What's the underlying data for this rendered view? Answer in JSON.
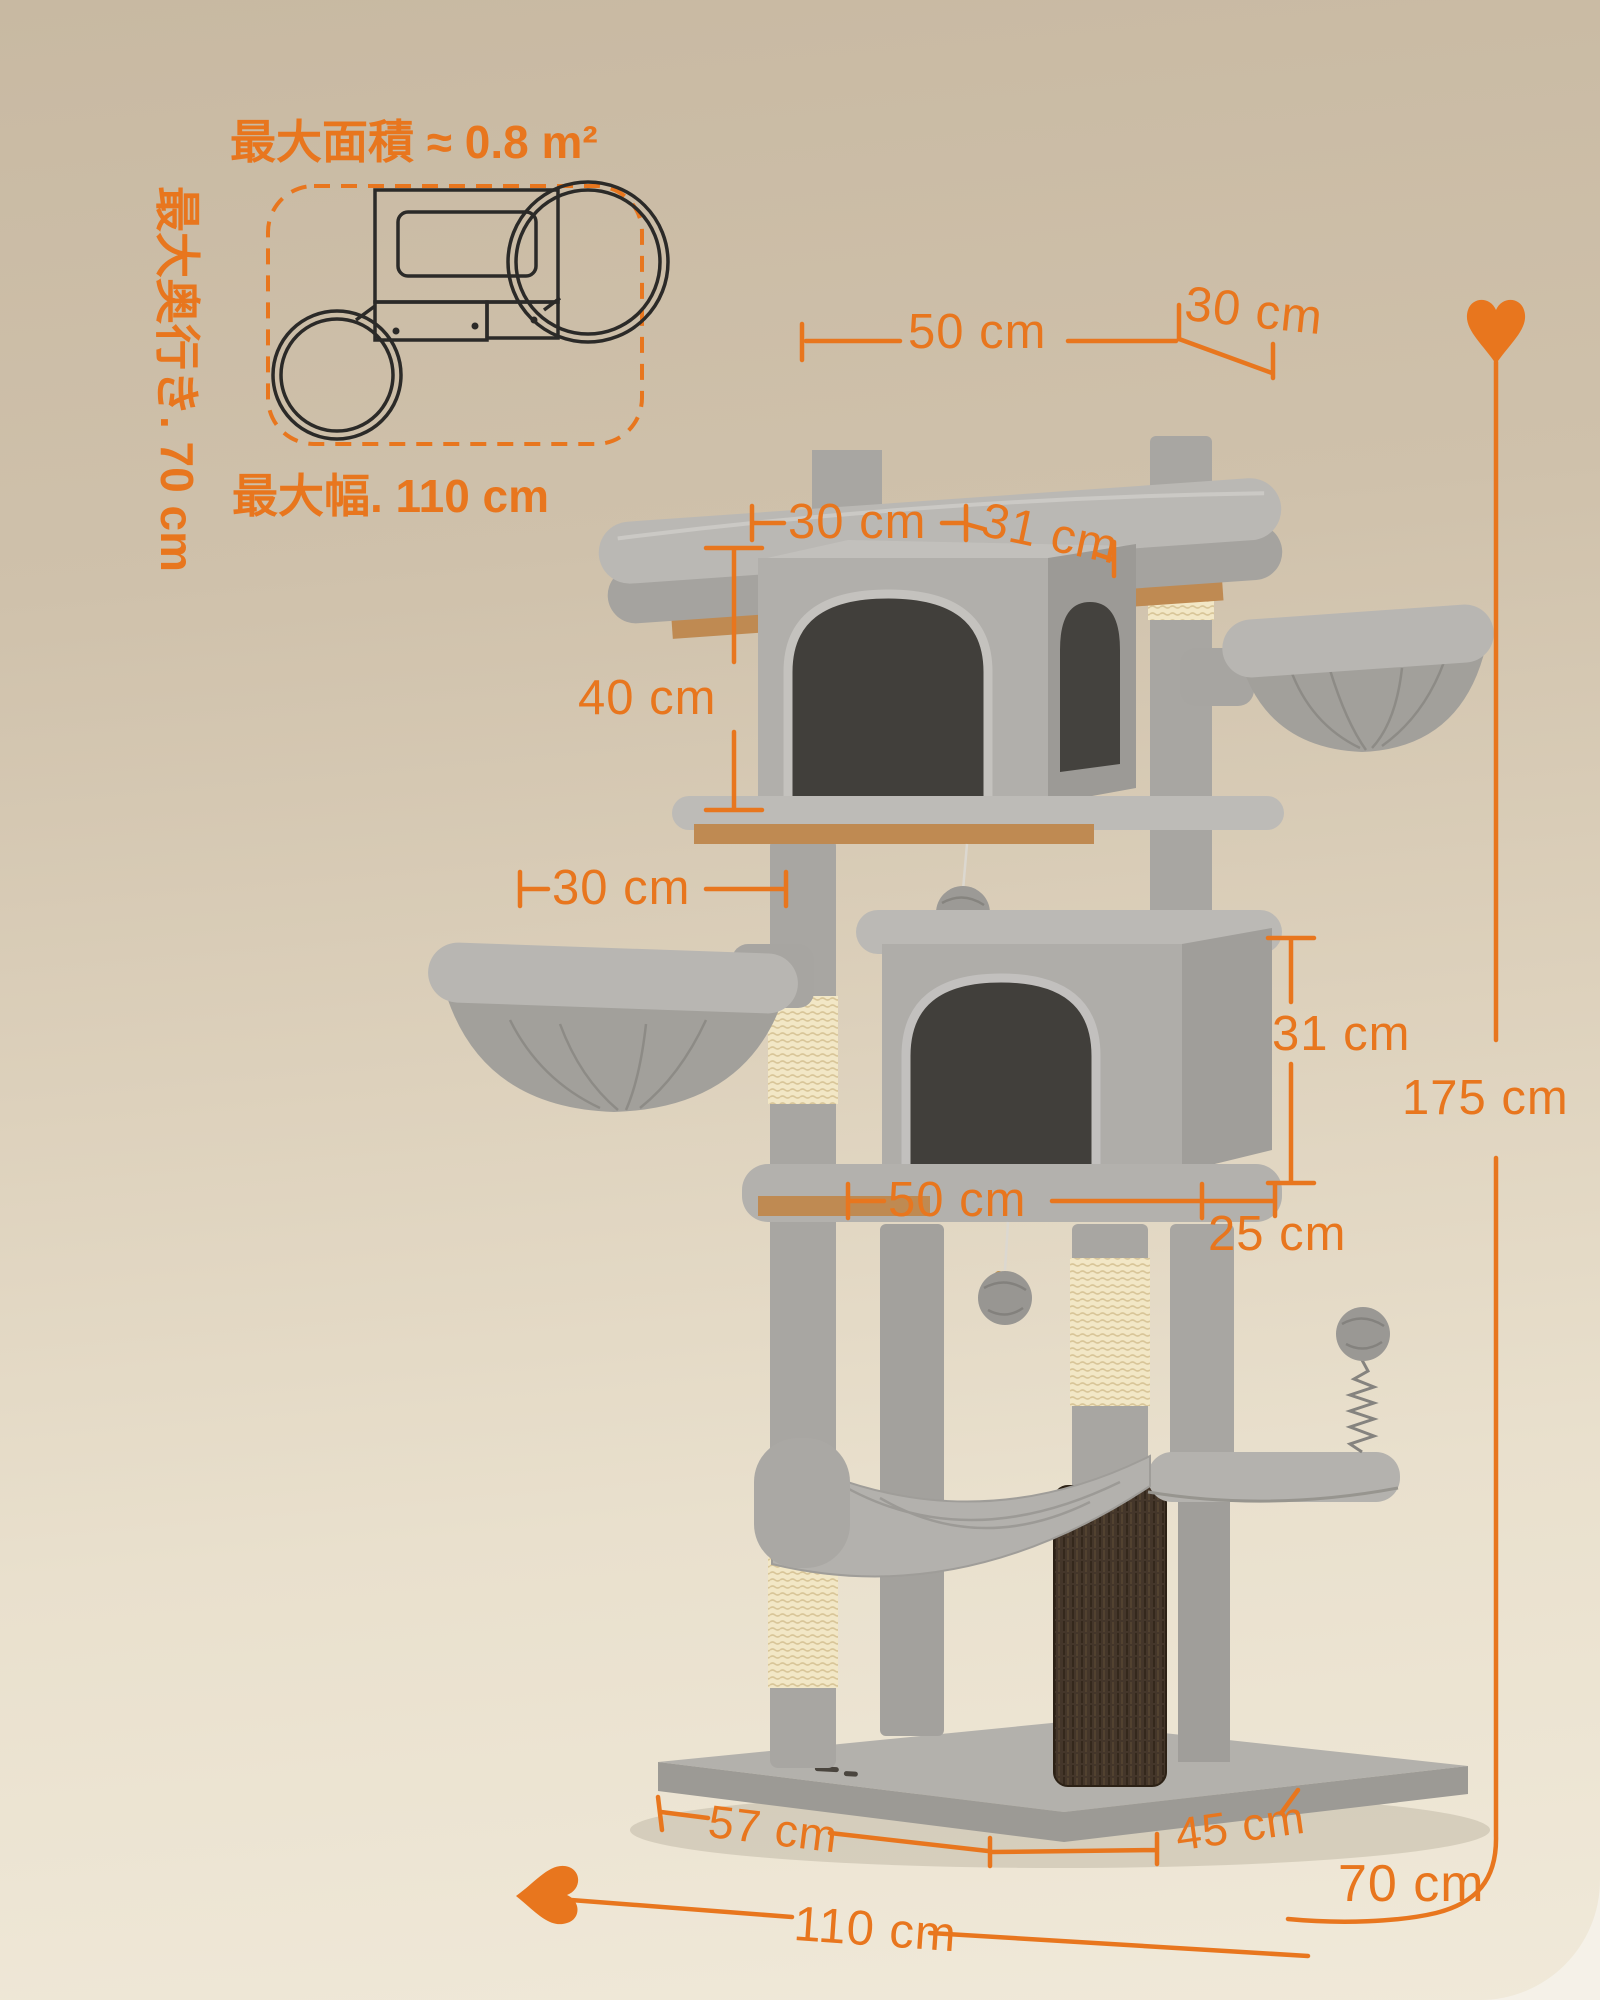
{
  "theme": {
    "accent": "#e8761e",
    "background_top": "#c8b9a2",
    "background_bottom": "#f0e9d9",
    "plush_gray": "#aeacaa",
    "sisal_cream": "#f2e7c6",
    "wood_tan": "#bf8a52",
    "opening_dark": "#413f3b",
    "brush_brown": "#44362a",
    "plan_line_black": "#2b2a28"
  },
  "icons": {
    "arrow_up": "heart-arrow-up",
    "arrow_left": "heart-arrow-left"
  },
  "floorplan": {
    "area_label": "最大面積 ≈ 0.8 m²",
    "depth_label": "最大奥行き. 70 cm",
    "width_label": "最大幅. 110 cm"
  },
  "dimensions": {
    "top_platform_width": "50 cm",
    "top_platform_depth": "30 cm",
    "upper_house_width": "30 cm",
    "upper_house_depth": "31 cm",
    "upper_house_height": "40 cm",
    "left_basket_width": "30 cm",
    "lower_house_height": "31 cm",
    "total_height": "175 cm",
    "lower_house_width": "50 cm",
    "lower_shelf_depth": "25 cm",
    "base_width": "57 cm",
    "base_depth": "45 cm",
    "footprint_depth": "70 cm",
    "footprint_width": "110 cm"
  }
}
